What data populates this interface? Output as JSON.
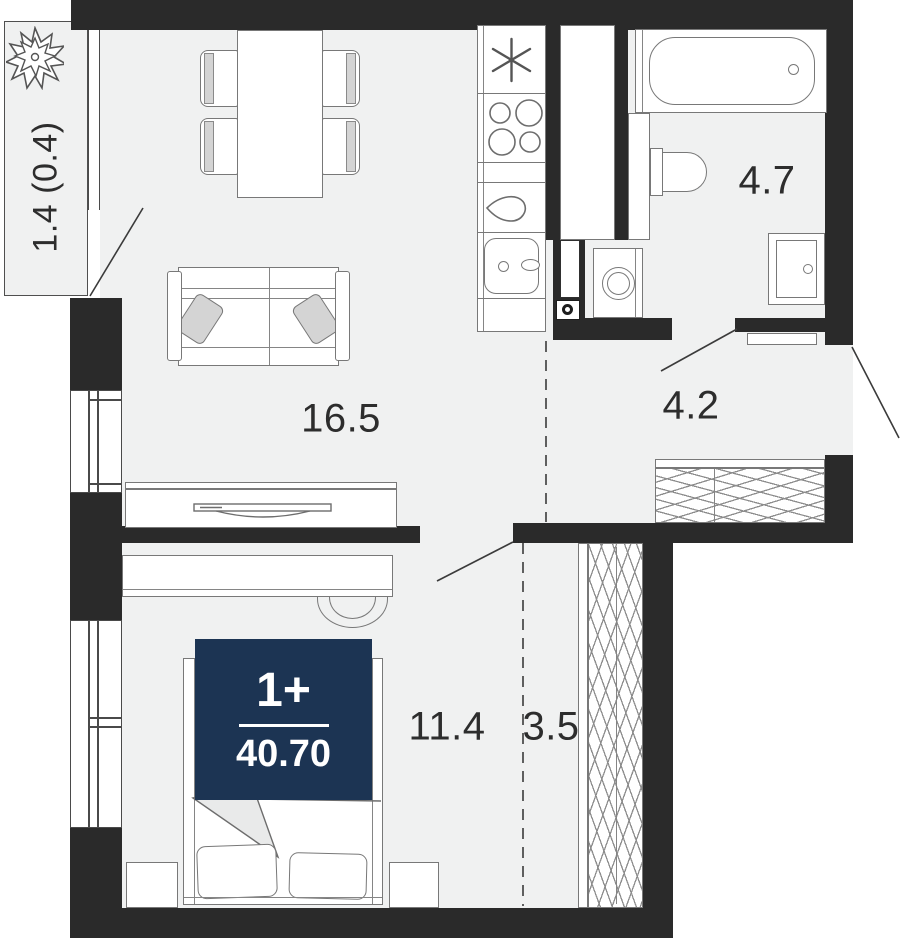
{
  "badge": {
    "rooms_label": "1+",
    "area_value": "40.70"
  },
  "rooms": {
    "balcony_area": "1.4 (0.4)",
    "living_area": "16.5",
    "bathroom_area": "4.7",
    "hall_area": "4.2",
    "bedroom_area": "11.4",
    "corridor_area": "3.5"
  },
  "colors": {
    "wall": "#2a2a2a",
    "floor": "#f0f1f1",
    "outline": "#787878",
    "accent": "#d4d4d4",
    "badge_bg": "#1c3453",
    "badge_text": "#ffffff",
    "label_text": "#2d2d2d"
  }
}
